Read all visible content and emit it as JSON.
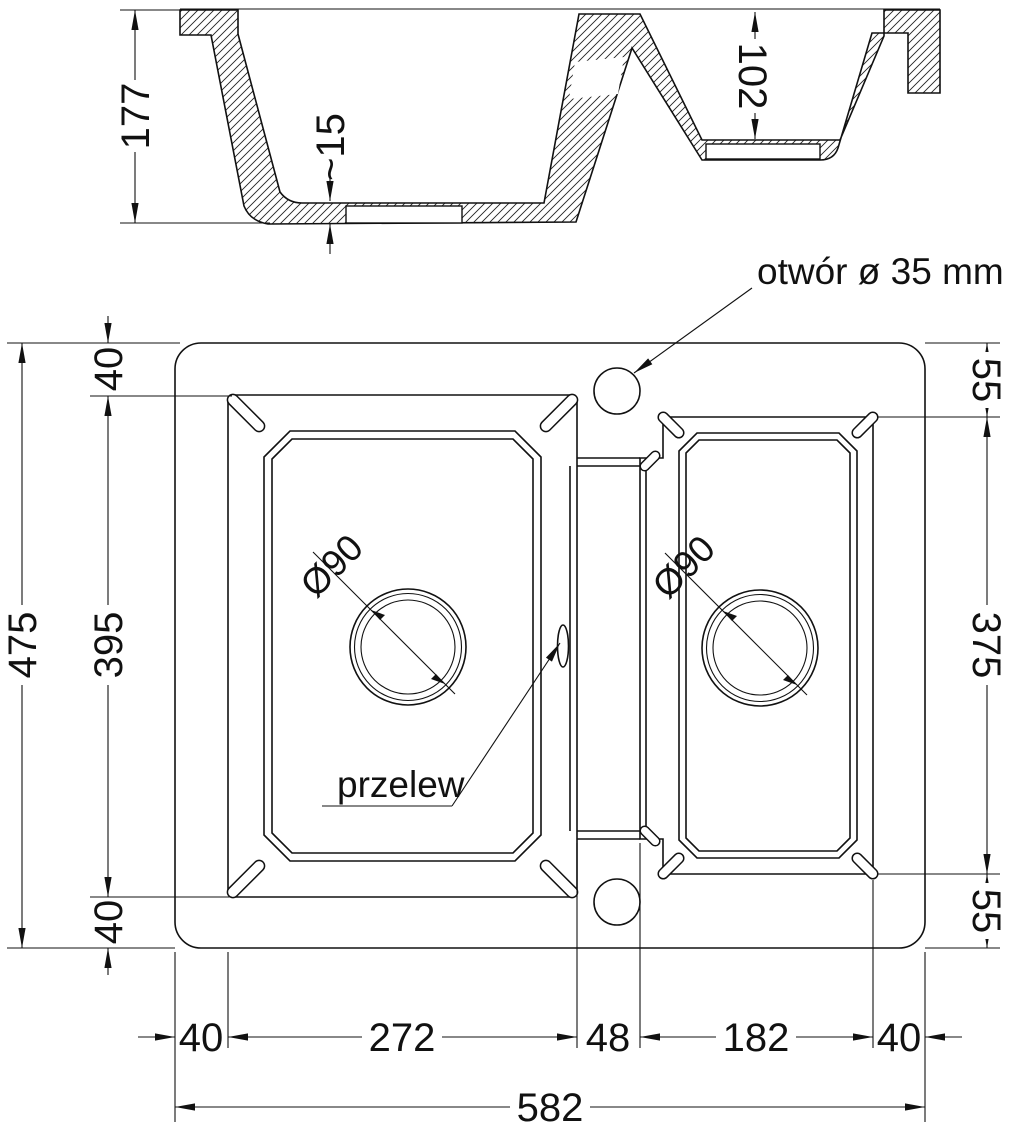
{
  "title": "kitchen sink technical drawing",
  "section_view": {
    "depth_main": "177",
    "floor_thickness": "~15",
    "depth_small": "102"
  },
  "plan_view": {
    "faucet_hole_label": "otwór ø 35 mm",
    "overflow_label": "przelew",
    "drain_left_label": "Ø90",
    "drain_right_label": "Ø90",
    "dims": {
      "total_height": "475",
      "bowl_height": "395",
      "top_margin": "40",
      "bottom_margin": "40",
      "right_top_margin": "55",
      "right_bowl_height": "375",
      "right_bottom_margin": "55",
      "left_margin": "40",
      "bowl_width": "272",
      "divider_width": "48",
      "right_bowl_width": "182",
      "right_margin": "40",
      "total_width": "582"
    }
  },
  "colors": {
    "line": "#111111",
    "background": "#ffffff"
  }
}
